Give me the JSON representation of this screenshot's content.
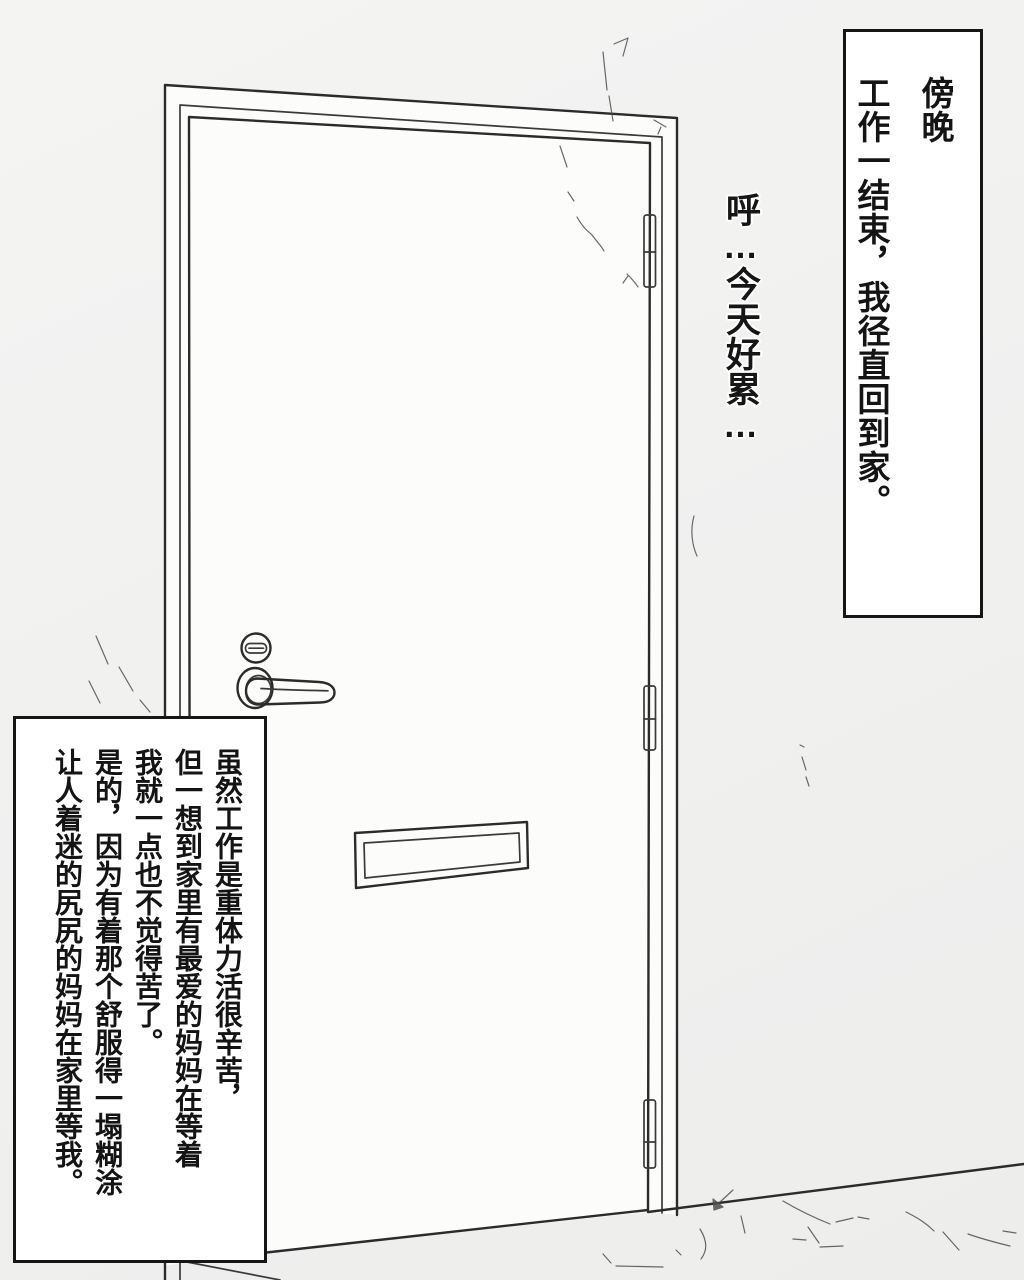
{
  "page": {
    "background_color": "#f1f1f0",
    "ink_color": "#2b2b2b"
  },
  "illustration": {
    "description": "line-art front door with frame, hinges, lock, lever handle and mail slot",
    "wall_fill": "#f1f1f0",
    "frame_fill": "#fcfcfb",
    "door_fill": "#e8e8e6",
    "hinge_fill": "#f4f4f3",
    "hardware_fill": "#f3f3f2",
    "mailslot_fill": "#efefed"
  },
  "captions": {
    "top_right": {
      "lines": [
        "傍晚",
        "工作一结束，我径直回到家。"
      ]
    },
    "floating": {
      "text": "呼…今天好累…"
    },
    "bottom_left": {
      "lines": [
        "虽然工作是重体力活很辛苦，",
        "但一想到家里有最爱的妈妈在等着",
        "我就一点也不觉得苦了。",
        "是的，因为有着那个舒服得一塌糊涂",
        "让人着迷的尻尻的妈妈在家里等我。"
      ]
    }
  }
}
